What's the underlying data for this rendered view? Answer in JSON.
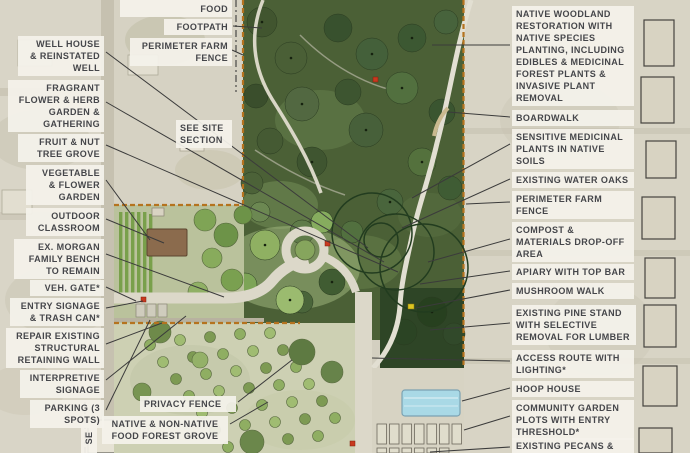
{
  "colors": {
    "fence_orange": "#b5731f",
    "leader_line": "#3b3b3b",
    "label_bg": "#f4f2ebee",
    "label_text": "#45464a",
    "marker_red": "#c8391f",
    "marker_yellow": "#ddc520",
    "hoop_house_blue": "#a9d9e6"
  },
  "callouts": [
    {
      "id": "well-house",
      "text": "WELL HOUSE\n& REINSTATED\nWELL",
      "x": 18,
      "y": 36,
      "w": 86,
      "align": "right",
      "line": [
        106,
        52,
        368,
        248
      ]
    },
    {
      "id": "fragrant-garden",
      "text": "FRAGRANT\nFLOWER & HERB\nGARDEN &\nGATHERING",
      "x": 8,
      "y": 80,
      "w": 96,
      "align": "right",
      "line": [
        106,
        102,
        384,
        262
      ]
    },
    {
      "id": "fruit-nut-grove",
      "text": "FRUIT & NUT\nTREE GROVE",
      "x": 18,
      "y": 134,
      "w": 86,
      "align": "right",
      "line": [
        106,
        145,
        398,
        272
      ]
    },
    {
      "id": "vegetable-garden",
      "text": "VEGETABLE\n& FLOWER\nGARDEN",
      "x": 26,
      "y": 165,
      "w": 78,
      "align": "right",
      "line": [
        106,
        180,
        150,
        240
      ]
    },
    {
      "id": "outdoor-classroom",
      "text": "OUTDOOR\nCLASSROOM",
      "x": 26,
      "y": 208,
      "w": 78,
      "align": "right",
      "line": [
        106,
        219,
        164,
        243
      ]
    },
    {
      "id": "morgan-bench",
      "text": "EX. MORGAN\nFAMILY BENCH\nTO REMAIN",
      "x": 14,
      "y": 239,
      "w": 90,
      "align": "right",
      "line": [
        106,
        254,
        224,
        297
      ]
    },
    {
      "id": "veh-gate",
      "text": "VEH. GATE*",
      "x": 30,
      "y": 280,
      "w": 74,
      "align": "right",
      "line": [
        106,
        287,
        136,
        301
      ]
    },
    {
      "id": "entry-signage",
      "text": "ENTRY SIGNAGE\n& TRASH CAN*",
      "x": 10,
      "y": 298,
      "w": 94,
      "align": "right",
      "line": [
        106,
        308,
        143,
        301
      ]
    },
    {
      "id": "retaining-wall",
      "text": "REPAIR EXISTING\nSTRUCTURAL\nRETAINING WALL",
      "x": 6,
      "y": 328,
      "w": 98,
      "align": "right",
      "line": [
        106,
        344,
        162,
        323
      ]
    },
    {
      "id": "interpretive-signage",
      "text": "INTERPRETIVE\nSIGNAGE",
      "x": 20,
      "y": 370,
      "w": 84,
      "align": "right",
      "line": [
        106,
        380,
        186,
        316
      ]
    },
    {
      "id": "parking",
      "text": "PARKING (3\nSPOTS)",
      "x": 30,
      "y": 400,
      "w": 74,
      "align": "right",
      "line": [
        106,
        410,
        150,
        320
      ]
    },
    {
      "id": "wilder-food",
      "text": "WILDER & FARMED\nFOOD",
      "x": 120,
      "y": -11,
      "w": 112,
      "align": "right"
    },
    {
      "id": "footpath",
      "text": "FOOTPATH",
      "x": 164,
      "y": 19,
      "w": 68,
      "align": "right",
      "line": [
        233,
        26,
        262,
        28
      ]
    },
    {
      "id": "perimeter-fence-nw",
      "text": "PERIMETER FARM\nFENCE",
      "x": 130,
      "y": 38,
      "w": 102,
      "align": "right",
      "line": [
        232,
        50,
        243,
        55
      ]
    },
    {
      "id": "see-site-section",
      "text": "SEE SITE\nSECTION",
      "x": 176,
      "y": 120,
      "w": 56,
      "align": "left"
    },
    {
      "id": "privacy-fence",
      "text": "PRIVACY FENCE",
      "x": 140,
      "y": 396,
      "w": 96,
      "align": "left",
      "line": [
        238,
        402,
        292,
        360
      ]
    },
    {
      "id": "food-forest-grove",
      "text": "NATIVE & NON-NATIVE\nFOOD FOREST GROVE",
      "x": 102,
      "y": 416,
      "w": 126,
      "align": "center",
      "line": [
        230,
        424,
        268,
        402
      ]
    },
    {
      "id": "section-marker-se",
      "text": "SE",
      "x": 74,
      "y": 430,
      "w": 30,
      "align": "center",
      "rotate": true
    },
    {
      "id": "native-woodland",
      "text": "NATIVE WOODLAND\nRESTORATION WITH\nNATIVE SPECIES\nPLANTING, INCLUDING\nEDIBLES & MEDICINAL\nFOREST PLANTS &\nINVASIVE PLANT\nREMOVAL",
      "x": 512,
      "y": 6,
      "w": 122,
      "align": "left",
      "line": [
        510,
        45,
        432,
        45
      ]
    },
    {
      "id": "boardwalk",
      "text": "BOARDWALK",
      "x": 512,
      "y": 110,
      "w": 122,
      "align": "left",
      "line": [
        510,
        117,
        448,
        112
      ]
    },
    {
      "id": "sensitive-medicinal",
      "text": "SENSITIVE MEDICINAL\nPLANTS IN NATIVE\nSOILS",
      "x": 512,
      "y": 129,
      "w": 122,
      "align": "left",
      "line": [
        510,
        144,
        412,
        198
      ]
    },
    {
      "id": "water-oaks",
      "text": "EXISTING WATER OAKS",
      "x": 512,
      "y": 172,
      "w": 122,
      "align": "left",
      "line": [
        510,
        179,
        402,
        228
      ]
    },
    {
      "id": "perimeter-fence-e",
      "text": "PERIMETER FARM\nFENCE",
      "x": 512,
      "y": 191,
      "w": 122,
      "align": "left",
      "line": [
        510,
        202,
        466,
        204
      ]
    },
    {
      "id": "compost-dropoff",
      "text": "COMPOST &\nMATERIALS DROP-OFF\nAREA",
      "x": 512,
      "y": 222,
      "w": 122,
      "align": "left",
      "line": [
        510,
        239,
        428,
        262
      ]
    },
    {
      "id": "apiary",
      "text": "APIARY WITH TOP BAR",
      "x": 512,
      "y": 264,
      "w": 122,
      "align": "left",
      "line": [
        510,
        271,
        420,
        284
      ]
    },
    {
      "id": "mushroom-walk",
      "text": "MUSHROOM WALK",
      "x": 512,
      "y": 283,
      "w": 122,
      "align": "left",
      "line": [
        510,
        290,
        416,
        308
      ]
    },
    {
      "id": "pine-stand",
      "text": "EXISTING PINE STAND\nWITH SELECTIVE\nREMOVAL FOR LUMBER",
      "x": 512,
      "y": 305,
      "w": 124,
      "align": "left",
      "line": [
        510,
        323,
        430,
        330
      ]
    },
    {
      "id": "access-route",
      "text": "ACCESS ROUTE WITH\nLIGHTING*",
      "x": 512,
      "y": 350,
      "w": 122,
      "align": "left",
      "line": [
        510,
        361,
        372,
        358
      ]
    },
    {
      "id": "hoop-house",
      "text": "HOOP HOUSE",
      "x": 512,
      "y": 381,
      "w": 122,
      "align": "left",
      "line": [
        510,
        388,
        462,
        401
      ]
    },
    {
      "id": "community-garden",
      "text": "COMMUNITY GARDEN\nPLOTS WITH ENTRY\nTHRESHOLD*",
      "x": 512,
      "y": 400,
      "w": 122,
      "align": "left",
      "line": [
        510,
        416,
        464,
        430
      ]
    },
    {
      "id": "existing-pecans",
      "text": "EXISTING PECANS &\nMULCH AREA",
      "x": 512,
      "y": 438,
      "w": 122,
      "align": "left",
      "line": [
        510,
        447,
        430,
        452
      ]
    }
  ]
}
